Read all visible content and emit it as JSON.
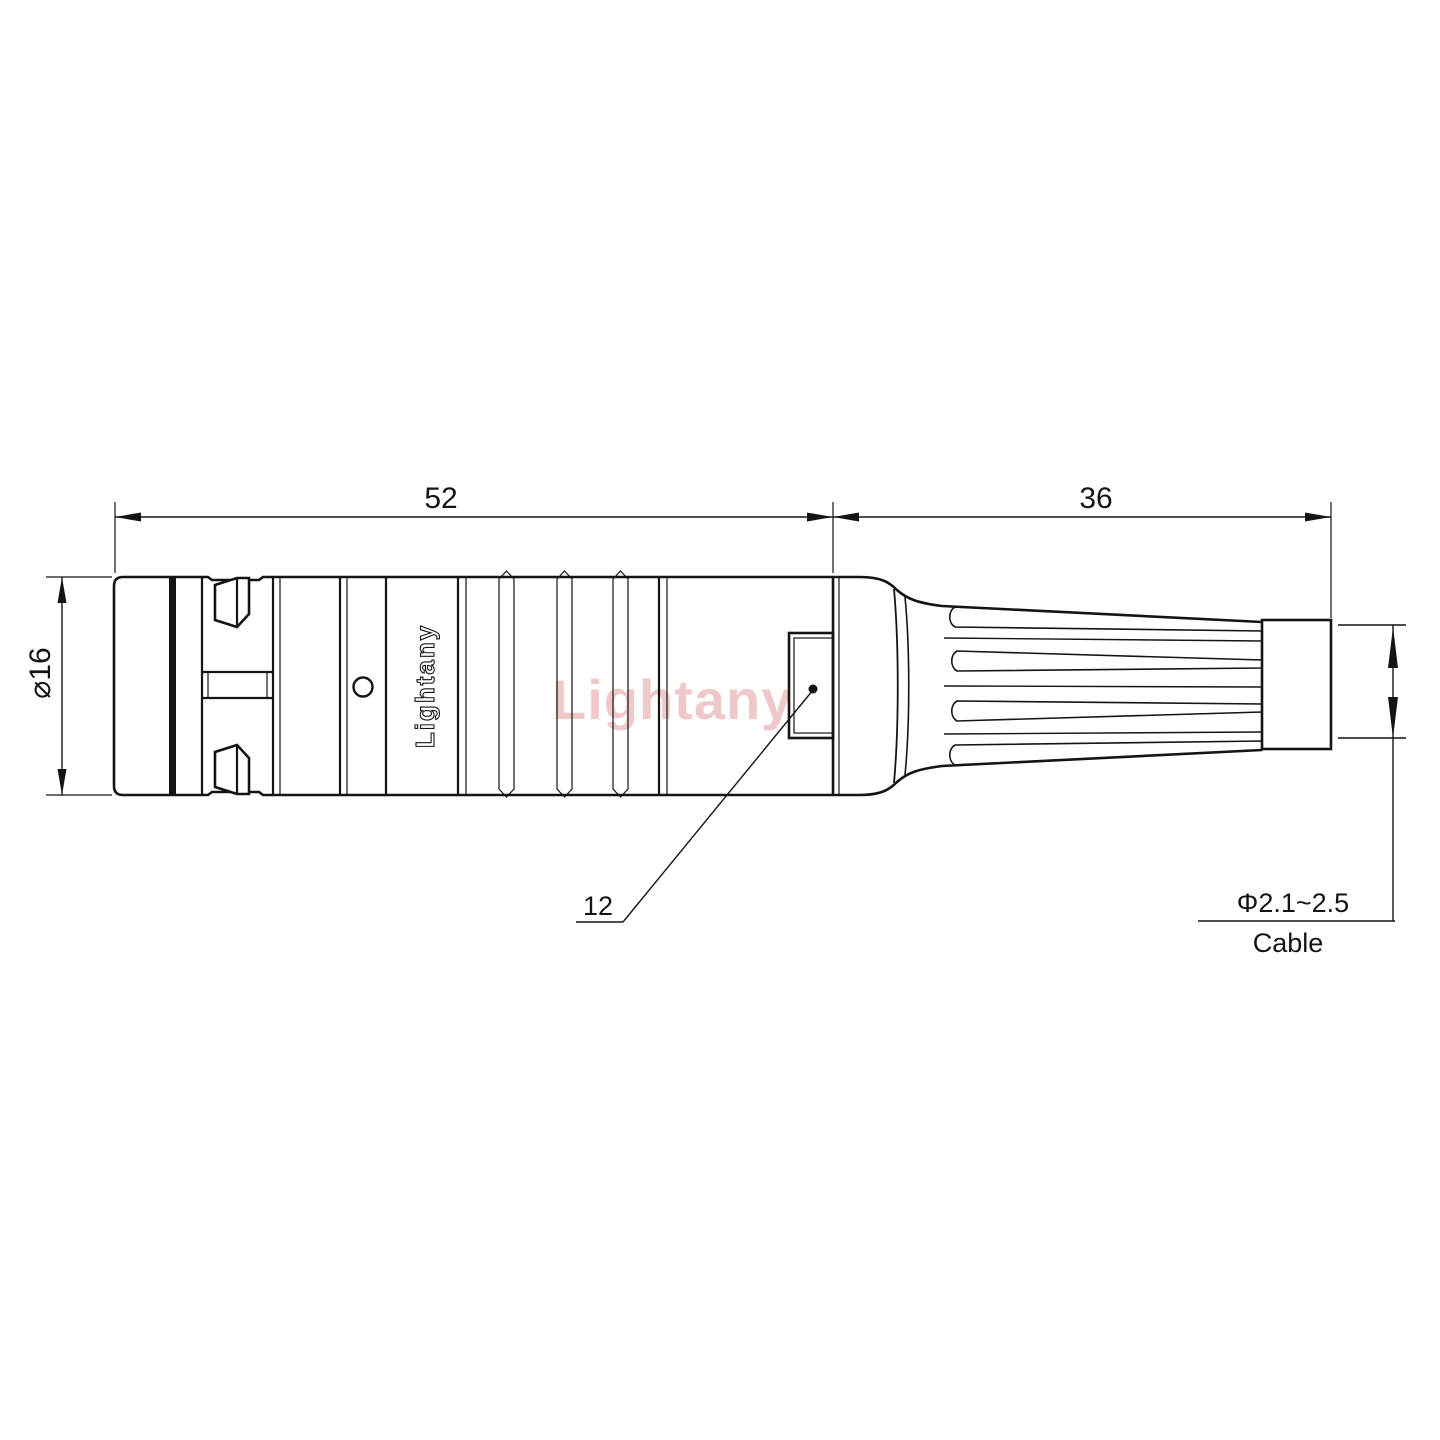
{
  "drawing": {
    "watermark": "Lightany",
    "brand_marking": "Lightany",
    "dimensions": {
      "front_length": "52",
      "rear_length": "36",
      "body_diameter": "⌀16",
      "inner_ref": "12",
      "cable_diameter_range": "Φ2.1~2.5",
      "cable_label": "Cable"
    },
    "colors": {
      "line": "#141414",
      "background": "#ffffff",
      "watermark": "#dd8888"
    }
  }
}
